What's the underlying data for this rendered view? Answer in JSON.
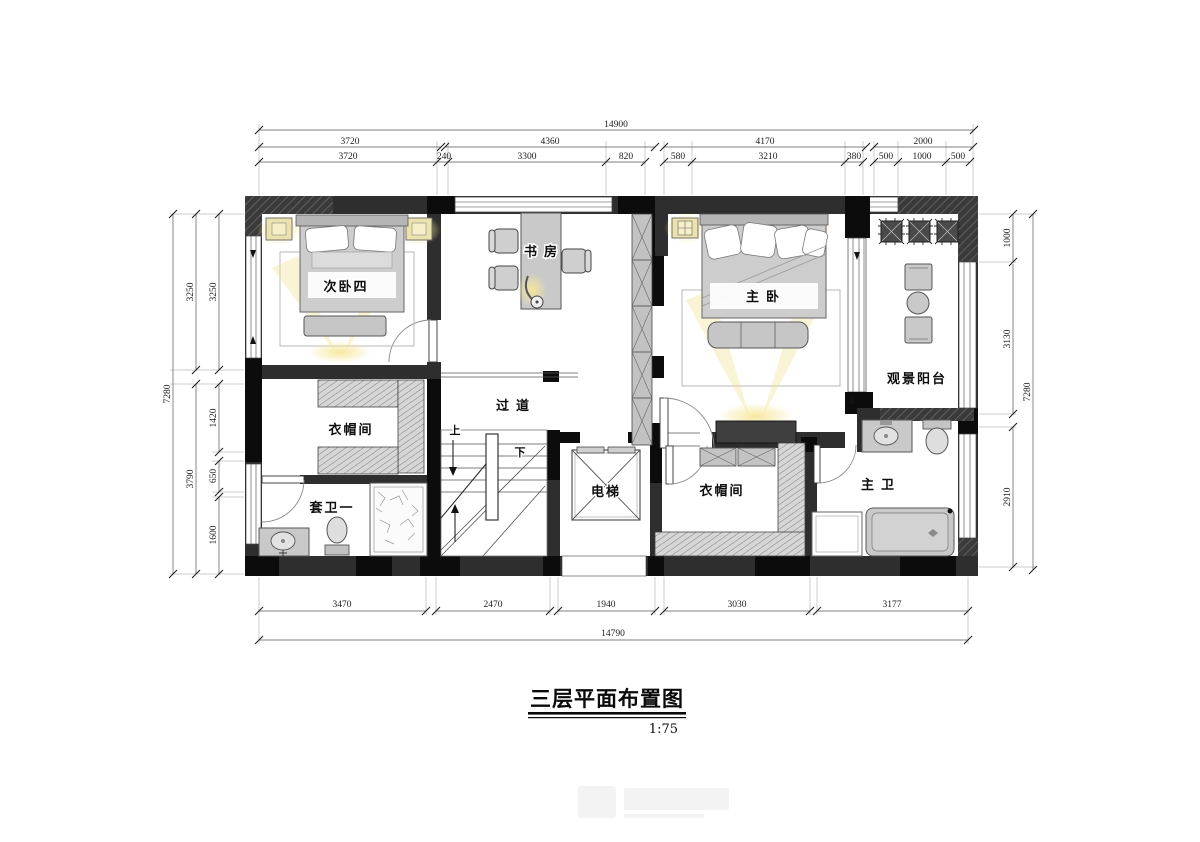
{
  "title": {
    "text": "三层平面布置图",
    "scale": "1:75"
  },
  "rooms": {
    "bedroom4": "次卧四",
    "study": "书房",
    "master_bedroom": "主卧",
    "balcony": "观景阳台",
    "cloakroom_left": "衣帽间",
    "corridor": "过道",
    "stairs_up": "上",
    "stairs_down": "下",
    "suite_bath_one": "套卫一",
    "elevator": "电梯",
    "cloakroom_right": "衣帽间",
    "master_bath": "主卫"
  },
  "dimensions": {
    "top": {
      "total": "14900",
      "row2": [
        "3720",
        "4360",
        "4170",
        "2000"
      ],
      "row3": [
        "3720",
        "240",
        "3300",
        "820",
        "580",
        "3210",
        "380",
        "500",
        "1000",
        "500"
      ]
    },
    "bottom": {
      "row1": [
        "3470",
        "2470",
        "1940",
        "3030",
        "3177"
      ],
      "total": "14790"
    },
    "left": {
      "total": "7280",
      "mid": [
        "3250",
        "3790"
      ],
      "inner": [
        "3250",
        "1420",
        "650",
        "1600"
      ]
    },
    "right": {
      "total": "7280",
      "inner": [
        "1000",
        "3130",
        "2910"
      ]
    }
  },
  "colors": {
    "wall": "#2e2e2e",
    "wall_black": "#0c0c0c",
    "furniture": "#c9c9c9",
    "glow": "#f6e79b"
  }
}
